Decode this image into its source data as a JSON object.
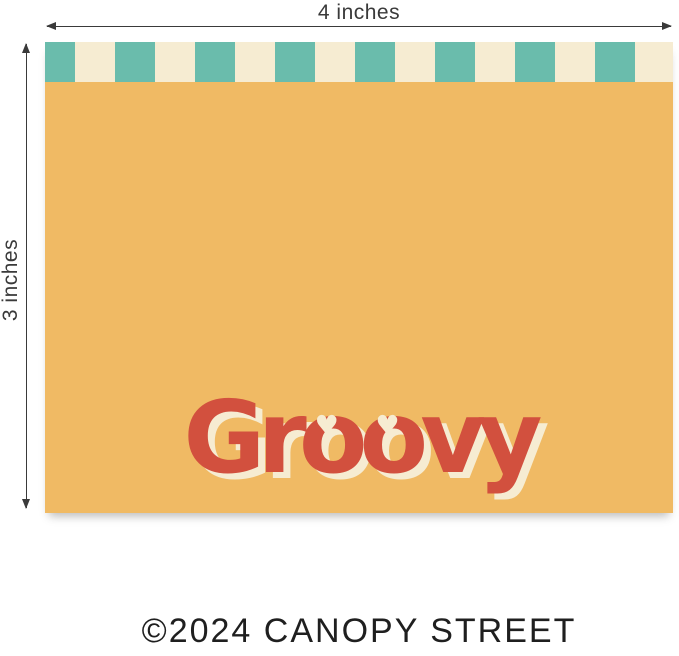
{
  "dimensions": {
    "width_label": "4 inches",
    "height_label": "3 inches"
  },
  "card": {
    "title": "Groovy",
    "heart_letter": "o",
    "heart_icon_glyph": "♥",
    "stripe": {
      "teal_block_count": 8,
      "cream_block_count": 8,
      "block_width_px": 40,
      "first_block_width_px": 30,
      "height_px": 40
    }
  },
  "footer": {
    "copyright": "©2024 CANOPY STREET"
  },
  "colors": {
    "card_background": "#f0ba64",
    "stripe_teal": "#6abcac",
    "stripe_cream": "#f6ecd2",
    "title_red": "#d2503e",
    "title_shadow_cream": "#f6ecd2",
    "annotation_gray": "#3a3a3a",
    "copyright_dark": "#1f1f1f",
    "page_background": "#ffffff"
  }
}
